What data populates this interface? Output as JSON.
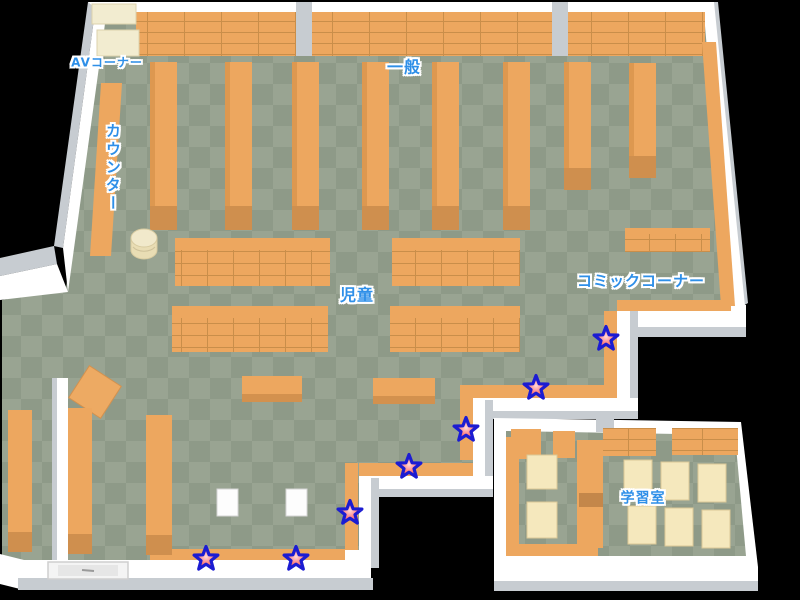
{
  "page": {
    "kind": "library-floor-map",
    "width": 800,
    "height": 600,
    "background": "#000000"
  },
  "map": {
    "area_labels": [
      {
        "id": "av-corner",
        "text": "AVコーナー",
        "x": 107,
        "y": 63,
        "vertical": false,
        "size": 12
      },
      {
        "id": "counter",
        "text": "カウンター",
        "x": 112,
        "y": 168,
        "vertical": true,
        "size": 15
      },
      {
        "id": "general",
        "text": "一般",
        "x": 404,
        "y": 68,
        "vertical": false,
        "size": 16
      },
      {
        "id": "children",
        "text": "児童",
        "x": 357,
        "y": 296,
        "vertical": false,
        "size": 16
      },
      {
        "id": "comic-corner",
        "text": "コミックコーナー",
        "x": 641,
        "y": 282,
        "vertical": false,
        "size": 15
      },
      {
        "id": "study-room",
        "text": "学習室",
        "x": 643,
        "y": 499,
        "vertical": false,
        "size": 14
      }
    ],
    "star_markers": {
      "shape": "five-point-star",
      "count": 7,
      "positions": [
        {
          "x": 606,
          "y": 339
        },
        {
          "x": 536,
          "y": 388
        },
        {
          "x": 466,
          "y": 430
        },
        {
          "x": 409,
          "y": 467
        },
        {
          "x": 350,
          "y": 513
        },
        {
          "x": 296,
          "y": 559
        },
        {
          "x": 206,
          "y": 559
        }
      ]
    },
    "colors": {
      "background": "#000000",
      "floor_light": "#9aa593",
      "floor_dark": "#8e9a88",
      "shelf_orange": "#eda75f",
      "shelf_grid_line": "#c98e4a",
      "shelf_base_dark": "#cf8f4e",
      "wall_white": "#ffffff",
      "wall_gray": "#c7ccd1",
      "furniture_cream": "#f2ecd0",
      "desk_cream": "#f5e8bd",
      "label_blue": "#2e8fe8",
      "label_outline": "#ffffff",
      "star_fill": "#f24444",
      "star_center": "#ffd9d9",
      "star_outline": "#1c1cd2"
    }
  }
}
